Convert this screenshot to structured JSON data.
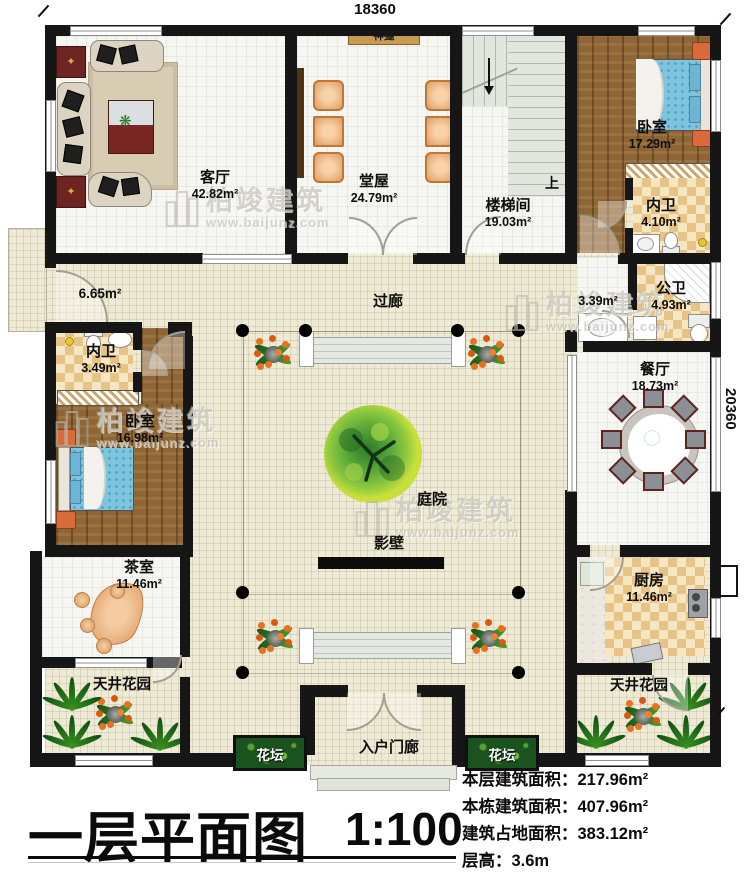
{
  "dimensions": {
    "top": "18360",
    "right": "20360"
  },
  "rooms": {
    "living": {
      "name": "客厅",
      "area": "42.82m²"
    },
    "shrine": {
      "name": "神龛"
    },
    "hall": {
      "name": "堂屋",
      "area": "24.79m²"
    },
    "stairwell": {
      "name": "楼梯间",
      "area": "19.03m²",
      "up_label": "上"
    },
    "bedroom_right": {
      "name": "卧室",
      "area": "17.29m²"
    },
    "ensuite_right": {
      "name": "内卫",
      "area": "4.10m²"
    },
    "vanity_area": {
      "area": "3.39m²"
    },
    "public_bath": {
      "name": "公卫",
      "area": "4.93m²"
    },
    "dining": {
      "name": "餐厅",
      "area": "18.73m²"
    },
    "side_porch": {
      "area": "6.65m²"
    },
    "corridor": {
      "name": "过廊"
    },
    "ensuite_left": {
      "name": "内卫",
      "area": "3.49m²"
    },
    "bedroom_left": {
      "name": "卧室",
      "area": "16.98m²"
    },
    "courtyard": {
      "name": "庭院"
    },
    "screen_wall": {
      "name": "影壁"
    },
    "tea_room": {
      "name": "茶室",
      "area": "11.46m²"
    },
    "kitchen": {
      "name": "厨房",
      "area": "11.46m²"
    },
    "patio_garden_left": {
      "name": "天井花园"
    },
    "patio_garden_right": {
      "name": "天井花园"
    },
    "flower_bed_left": {
      "name": "花坛"
    },
    "flower_bed_right": {
      "name": "花坛"
    },
    "entry_porch": {
      "name": "入户门廊"
    }
  },
  "title_block": {
    "title": "一层平面图",
    "scale": "1:100"
  },
  "stats": [
    {
      "label": "本层建筑面积：",
      "value": "217.96m²"
    },
    {
      "label": "本栋建筑面积：",
      "value": "407.96m²"
    },
    {
      "label": "建筑占地面积：",
      "value": "383.12m²"
    },
    {
      "label": "层高：",
      "value": "3.6m"
    }
  ],
  "watermark": {
    "brand": "柏竣建筑",
    "url": "www.baijunz.com"
  }
}
